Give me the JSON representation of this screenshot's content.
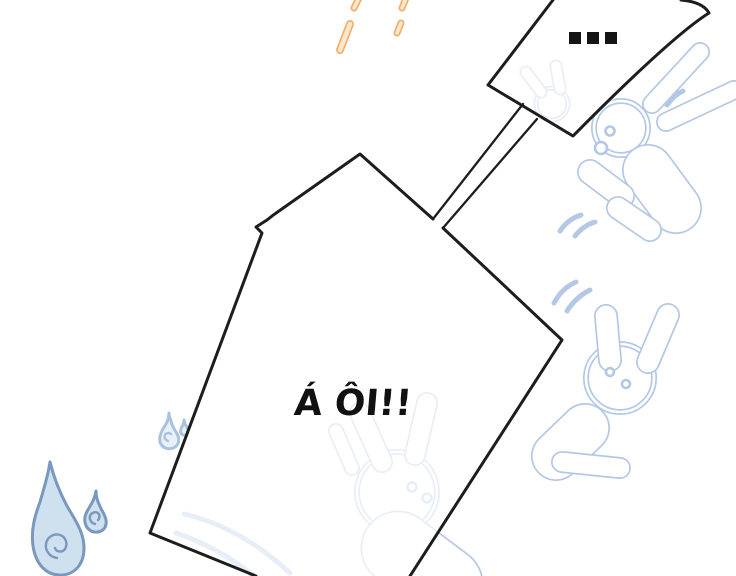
{
  "page": {
    "type": "comic-panel",
    "width": 736,
    "height": 576,
    "background": "#ffffff"
  },
  "bubbles": {
    "top_right": {
      "text": "...",
      "shape": "angular-tilted-quad",
      "fill": "#ffffff",
      "outline": "#1d1d1d"
    },
    "main": {
      "text": "Á ÔI!!",
      "shape": "angular-polygon",
      "fill": "#ffffff",
      "outline": "#1d1d1d"
    }
  },
  "text_color": "#111111",
  "decorations": {
    "rabbit_doodles": {
      "count": 4,
      "color": "#b4c8e6",
      "style": "double-line-outline",
      "ghost_opacity": 0.3
    },
    "water_drops": {
      "count": 4,
      "outline": "#7a98be",
      "fill": "#cfe1ef",
      "light_outline": "#a9c3dd",
      "light_fill": "#e9f1f8"
    },
    "rain_strokes": {
      "count": 4,
      "color": "#f2ad68",
      "core": "#fce8cd"
    },
    "motion_dashes": {
      "groups": 4,
      "color": "#b4c8e6"
    }
  }
}
